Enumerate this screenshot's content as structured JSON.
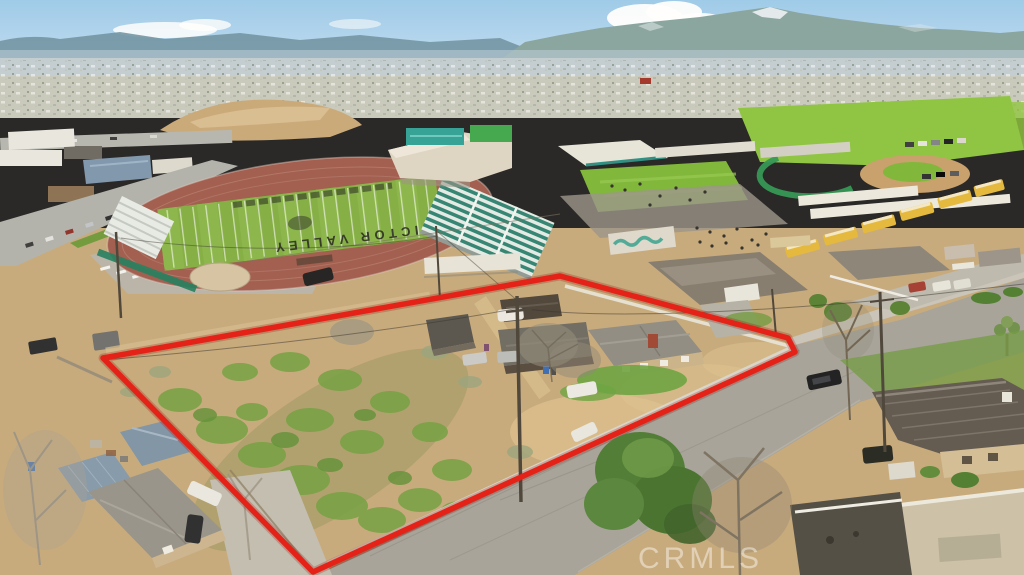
{
  "field": {
    "lettering": "VICTOR VALLEY"
  },
  "watermark": {
    "label": "CRMLS",
    "color": "#ffffff"
  },
  "property": {
    "outline_color": "#e31b12"
  },
  "palette": {
    "sky_top": "#9ccaeb",
    "sky_horizon": "#d3e7f5",
    "mountains": "#7d9aa4",
    "track": "#a05a4c",
    "field_green": "#82ad42",
    "dirt_lot": "#c6a97b",
    "asphalt": "#a5a29a",
    "bus_yellow": "#e3b83a",
    "scrub_green": "#71a03f"
  }
}
